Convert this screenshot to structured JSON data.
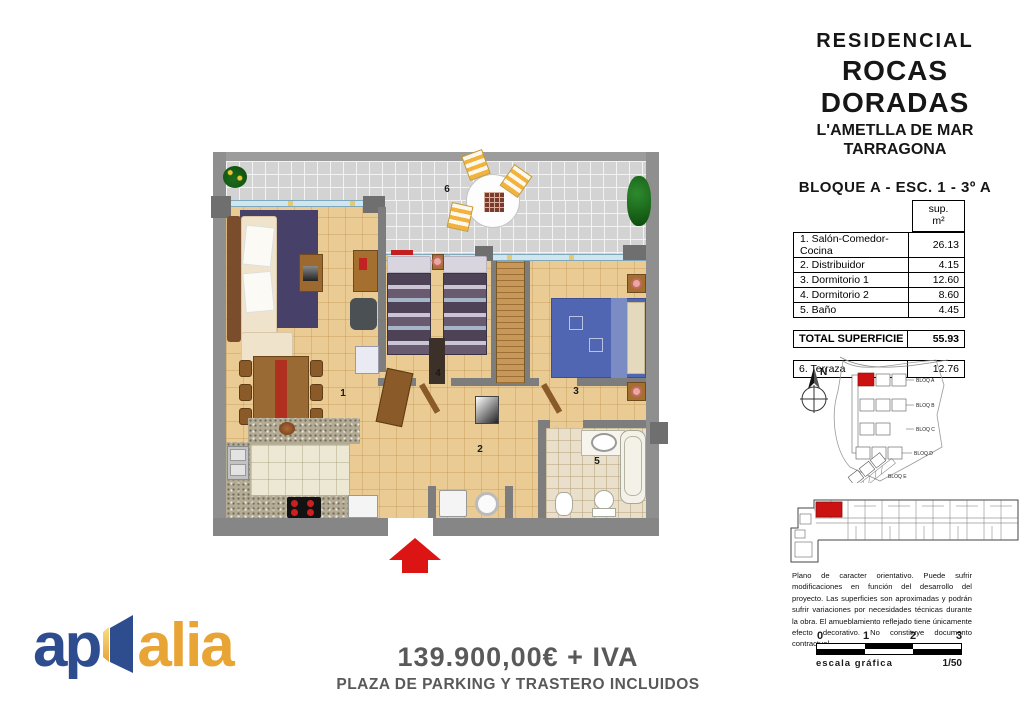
{
  "header": {
    "line1": "RESIDENCIAL",
    "line2": "ROCAS DORADAS",
    "line3": "L'AMETLLA DE MAR",
    "line4": "TARRAGONA",
    "block_line": "BLOQUE A -  ESC. 1 - 3º A"
  },
  "area_table": {
    "unit_header_line1": "sup.",
    "unit_header_line2": "m²",
    "rows": [
      {
        "label": "1. Salón-Comedor-Cocina",
        "value": "26.13"
      },
      {
        "label": "2. Distribuidor",
        "value": "4.15"
      },
      {
        "label": "3. Dormitorio 1",
        "value": "12.60"
      },
      {
        "label": "4. Dormitorio 2",
        "value": "8.60"
      },
      {
        "label": "5. Baño",
        "value": "4.45"
      }
    ],
    "total": {
      "label": "TOTAL SUPERFICIE",
      "value": "55.93"
    },
    "terrace": {
      "label": "6. Terraza",
      "value": "12.76"
    }
  },
  "floorplan": {
    "rooms": {
      "living": "1",
      "hall": "2",
      "bedroom1": "3",
      "bedroom2": "4",
      "bathroom": "5",
      "terrace": "6"
    }
  },
  "site_plan": {
    "north": "N",
    "blocks": [
      "BLOQ A",
      "BLOQ B",
      "BLOQ C",
      "BLOQ D",
      "BLOQ E"
    ]
  },
  "disclaimer": "Plano de caracter orientativo.  Puede sufrir modificaciones en función del desarrollo del proyecto. Las superficies son aproximadas y podrán sufrir variaciones por necesidades técnicas durante la obra. El amueblamiento reflejado tiene únicamente efecto decorativo. No constituye documento contractual.",
  "scale_bar": {
    "ticks": [
      "0",
      "1",
      "2",
      "3"
    ],
    "label": "escala gráfica",
    "ratio": "1/50"
  },
  "price": {
    "amount": "139.900,00€ + IVA",
    "note": "PLAZA DE PARKING Y TRASTERO INCLUIDOS"
  },
  "logo": {
    "part1": "ap",
    "part2": "alia"
  },
  "colors": {
    "accent_red": "#dd1414",
    "logo_blue": "#2e4d8e",
    "logo_orange": "#e8a434"
  }
}
